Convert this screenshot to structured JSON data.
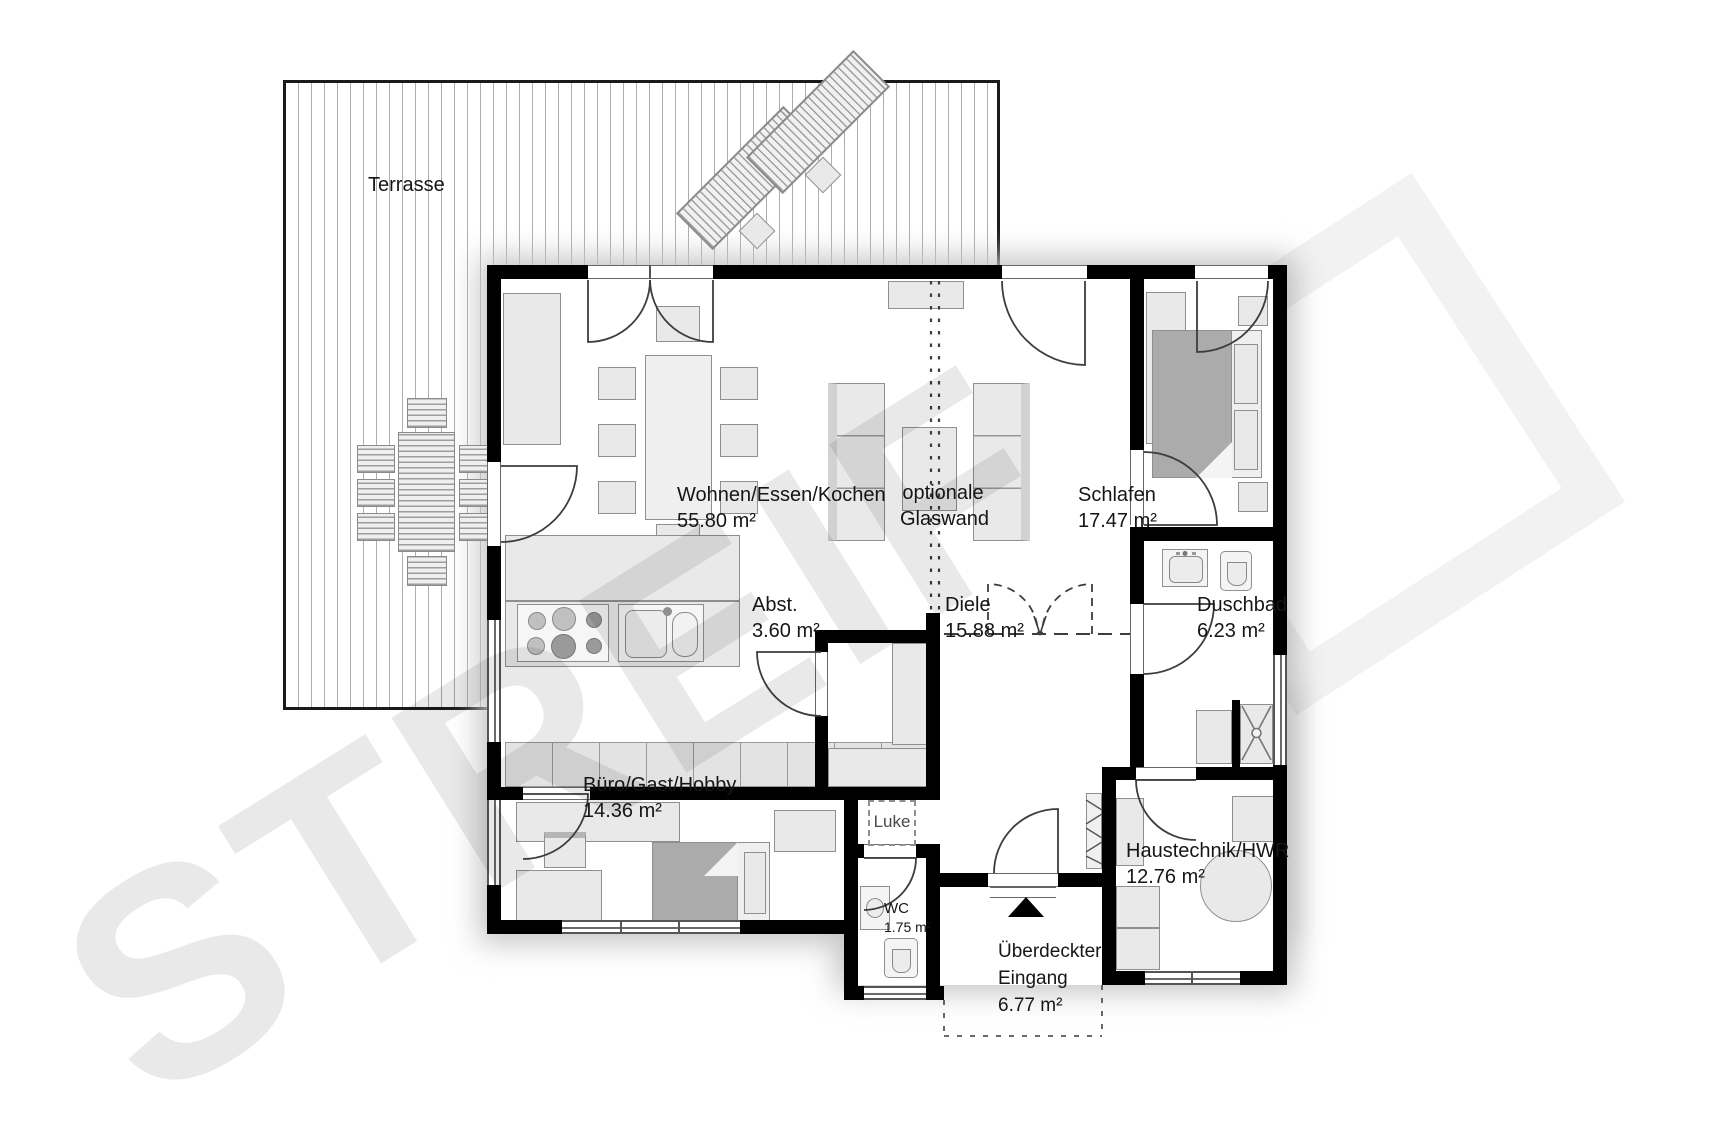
{
  "watermark": {
    "brand": "STREIF"
  },
  "rooms": {
    "terrasse": {
      "name": "Terrasse"
    },
    "wohnen": {
      "name": "Wohnen/Essen/Kochen",
      "area": "55.80 m²"
    },
    "glaswand": {
      "line1": "optionale",
      "line2": "Glaswand"
    },
    "schlafen": {
      "name": "Schlafen",
      "area": "17.47 m²"
    },
    "duschbad": {
      "name": "Duschbad",
      "area": "6.23 m²"
    },
    "abstell": {
      "name": "Abst.",
      "area": "3.60 m²"
    },
    "diele": {
      "name": "Diele",
      "area": "15.88 m²"
    },
    "luke": {
      "name": "Luke"
    },
    "buero": {
      "name": "Büro/Gast/Hobby",
      "area": "14.36 m²"
    },
    "wc": {
      "name": "WC",
      "area": "1.75 m²"
    },
    "eingang": {
      "line1": "Überdeckter",
      "line2": "Eingang",
      "area": "6.77 m²"
    },
    "haustechnik": {
      "name": "Haustechnik/HWR",
      "area": "12.76 m²"
    }
  },
  "colors": {
    "wall": "#000000",
    "hatch": "#adadad",
    "furniture": "#e9e9e9",
    "dark_furniture": "#ababab"
  }
}
